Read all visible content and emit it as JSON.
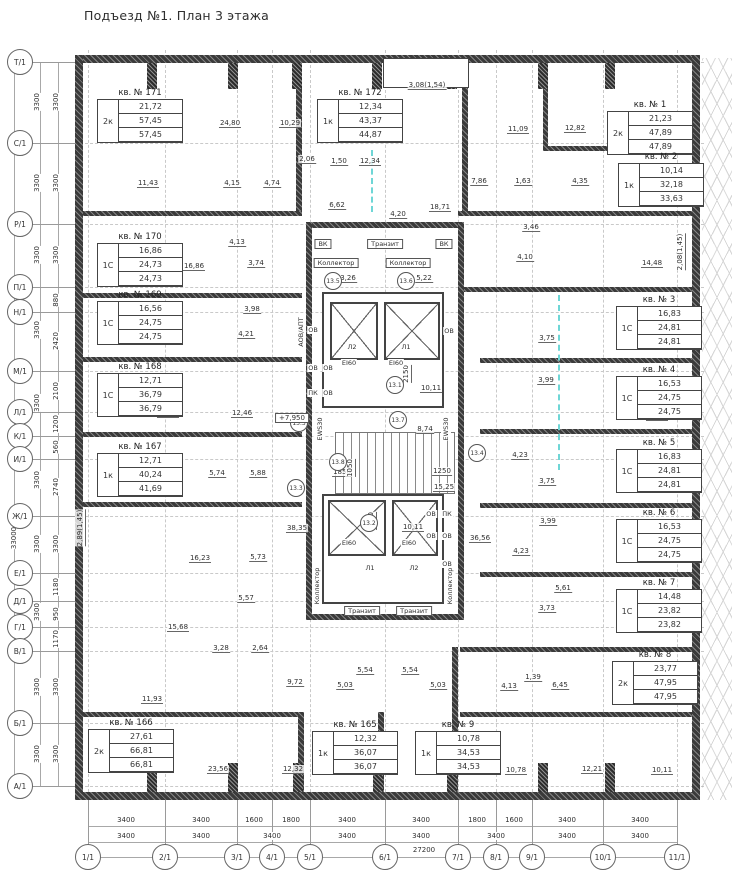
{
  "title": "Подъезд №1. План 3 этажа",
  "colors": {
    "wall": "#3a3a3a",
    "accent_cyan": "#6fd6d6",
    "grid": "#c9c9c9",
    "line": "#444444"
  },
  "axes": {
    "left": [
      {
        "label": "Т/1",
        "y": 62
      },
      {
        "label": "С/1",
        "y": 143
      },
      {
        "label": "Р/1",
        "y": 224
      },
      {
        "label": "П/1",
        "y": 287
      },
      {
        "label": "Н/1",
        "y": 312
      },
      {
        "label": "М/1",
        "y": 371
      },
      {
        "label": "Л/1",
        "y": 412
      },
      {
        "label": "К/1",
        "y": 436
      },
      {
        "label": "И/1",
        "y": 459
      },
      {
        "label": "Ж/1",
        "y": 516
      },
      {
        "label": "Е/1",
        "y": 573
      },
      {
        "label": "Д/1",
        "y": 601
      },
      {
        "label": "Г/1",
        "y": 627
      },
      {
        "label": "В/1",
        "y": 651
      },
      {
        "label": "Б/1",
        "y": 723
      },
      {
        "label": "А/1",
        "y": 786
      }
    ],
    "bottom": [
      {
        "label": "1/1",
        "x": 88
      },
      {
        "label": "2/1",
        "x": 165
      },
      {
        "label": "3/1",
        "x": 237
      },
      {
        "label": "4/1",
        "x": 272
      },
      {
        "label": "5/1",
        "x": 310
      },
      {
        "label": "6/1",
        "x": 385
      },
      {
        "label": "7/1",
        "x": 458
      },
      {
        "label": "8/1",
        "x": 496
      },
      {
        "label": "9/1",
        "x": 532
      },
      {
        "label": "10/1",
        "x": 603
      },
      {
        "label": "11/1",
        "x": 677
      }
    ]
  },
  "dimensions": {
    "bottom_row1": [
      {
        "v": "3400",
        "x": 126
      },
      {
        "v": "3400",
        "x": 201
      },
      {
        "v": "1600",
        "x": 254
      },
      {
        "v": "1800",
        "x": 291
      },
      {
        "v": "3400",
        "x": 347
      },
      {
        "v": "3400",
        "x": 421
      },
      {
        "v": "1800",
        "x": 477
      },
      {
        "v": "1600",
        "x": 514
      },
      {
        "v": "3400",
        "x": 567
      },
      {
        "v": "3400",
        "x": 640
      }
    ],
    "bottom_row2": [
      {
        "v": "3400",
        "x": 126
      },
      {
        "v": "3400",
        "x": 201
      },
      {
        "v": "3400",
        "x": 272
      },
      {
        "v": "3400",
        "x": 347
      },
      {
        "v": "3400",
        "x": 421
      },
      {
        "v": "3400",
        "x": 496
      },
      {
        "v": "3400",
        "x": 567
      },
      {
        "v": "3400",
        "x": 640
      }
    ],
    "bottom_total": {
      "v": "27200",
      "x": 424,
      "y": 850
    },
    "left_col1": [
      {
        "v": "3300",
        "y": 102
      },
      {
        "v": "3300",
        "y": 183
      },
      {
        "v": "3300",
        "y": 255
      },
      {
        "v": "3300",
        "y": 330
      },
      {
        "v": "3300",
        "y": 403
      },
      {
        "v": "3300",
        "y": 480
      },
      {
        "v": "3300",
        "y": 544
      },
      {
        "v": "3300",
        "y": 612
      },
      {
        "v": "3300",
        "y": 687
      },
      {
        "v": "3300",
        "y": 754
      }
    ],
    "left_col2": [
      {
        "v": "3300",
        "y": 102
      },
      {
        "v": "3300",
        "y": 183
      },
      {
        "v": "3300",
        "y": 255
      },
      {
        "v": "880",
        "y": 300
      },
      {
        "v": "2420",
        "y": 341
      },
      {
        "v": "2100",
        "y": 391
      },
      {
        "v": "1200",
        "y": 424
      },
      {
        "v": "560",
        "y": 447
      },
      {
        "v": "2740",
        "y": 487
      },
      {
        "v": "3300",
        "y": 544
      },
      {
        "v": "1180",
        "y": 587
      },
      {
        "v": "950",
        "y": 614
      },
      {
        "v": "1170",
        "y": 639
      },
      {
        "v": "3300",
        "y": 687
      },
      {
        "v": "3300",
        "y": 754
      }
    ],
    "left_total": {
      "v": "33000",
      "x": 14,
      "y": 538
    }
  },
  "apartments": [
    {
      "name": "кв. № 171",
      "rooms": "2к",
      "areas": [
        "21,72",
        "57,45",
        "57,45"
      ],
      "x": 97,
      "y": 88
    },
    {
      "name": "кв. № 172",
      "rooms": "1к",
      "areas": [
        "12,34",
        "43,37",
        "44,87"
      ],
      "x": 317,
      "y": 88
    },
    {
      "name": "кв. № 1",
      "rooms": "2к",
      "areas": [
        "21,23",
        "47,89",
        "47,89"
      ],
      "x": 607,
      "y": 100
    },
    {
      "name": "кв. № 2",
      "rooms": "1к",
      "areas": [
        "10,14",
        "32,18",
        "33,63"
      ],
      "x": 618,
      "y": 152
    },
    {
      "name": "кв. № 170",
      "rooms": "1С",
      "areas": [
        "16,86",
        "24,73",
        "24,73"
      ],
      "x": 97,
      "y": 232
    },
    {
      "name": "кв. № 169",
      "rooms": "1С",
      "areas": [
        "16,56",
        "24,75",
        "24,75"
      ],
      "x": 97,
      "y": 290
    },
    {
      "name": "кв. № 168",
      "rooms": "1С",
      "areas": [
        "12,71",
        "36,79",
        "36,79"
      ],
      "x": 97,
      "y": 362
    },
    {
      "name": "кв. № 167",
      "rooms": "1к",
      "areas": [
        "12,71",
        "40,24",
        "41,69"
      ],
      "x": 97,
      "y": 442
    },
    {
      "name": "кв. № 166",
      "rooms": "2к",
      "areas": [
        "27,61",
        "66,81",
        "66,81"
      ],
      "x": 88,
      "y": 718
    },
    {
      "name": "кв. № 165",
      "rooms": "1к",
      "areas": [
        "12,32",
        "36,07",
        "36,07"
      ],
      "x": 312,
      "y": 720
    },
    {
      "name": "кв. № 9",
      "rooms": "1к",
      "areas": [
        "10,78",
        "34,53",
        "34,53"
      ],
      "x": 415,
      "y": 720
    },
    {
      "name": "кв. № 3",
      "rooms": "1С",
      "areas": [
        "16,83",
        "24,81",
        "24,81"
      ],
      "x": 616,
      "y": 295
    },
    {
      "name": "кв. № 4",
      "rooms": "1С",
      "areas": [
        "16,53",
        "24,75",
        "24,75"
      ],
      "x": 616,
      "y": 365
    },
    {
      "name": "кв. № 5",
      "rooms": "1С",
      "areas": [
        "16,83",
        "24,81",
        "24,81"
      ],
      "x": 616,
      "y": 438
    },
    {
      "name": "кв. № 6",
      "rooms": "1С",
      "areas": [
        "16,53",
        "24,75",
        "24,75"
      ],
      "x": 616,
      "y": 508
    },
    {
      "name": "кв. № 7",
      "rooms": "1С",
      "areas": [
        "14,48",
        "23,82",
        "23,82"
      ],
      "x": 616,
      "y": 578
    },
    {
      "name": "кв. № 8",
      "rooms": "2к",
      "areas": [
        "23,77",
        "47,95",
        "47,95"
      ],
      "x": 612,
      "y": 650
    }
  ],
  "dim_labels": [
    {
      "v": "24,80",
      "x": 230,
      "y": 128
    },
    {
      "v": "10,29",
      "x": 290,
      "y": 128
    },
    {
      "v": "3,08(1,54)",
      "x": 427,
      "y": 90
    },
    {
      "v": "11,09",
      "x": 518,
      "y": 134
    },
    {
      "v": "12,82",
      "x": 575,
      "y": 133
    },
    {
      "v": "10,14",
      "x": 661,
      "y": 133
    },
    {
      "v": "11,43",
      "x": 148,
      "y": 188
    },
    {
      "v": "4,15",
      "x": 232,
      "y": 188
    },
    {
      "v": "4,74",
      "x": 272,
      "y": 188
    },
    {
      "v": "2,06",
      "x": 307,
      "y": 164
    },
    {
      "v": "1,50",
      "x": 339,
      "y": 166
    },
    {
      "v": "12,34",
      "x": 370,
      "y": 166
    },
    {
      "v": "7,86",
      "x": 479,
      "y": 186
    },
    {
      "v": "1,63",
      "x": 523,
      "y": 186
    },
    {
      "v": "4,35",
      "x": 580,
      "y": 186
    },
    {
      "v": "10,14",
      "x": 655,
      "y": 205
    },
    {
      "v": "6,62",
      "x": 337,
      "y": 210
    },
    {
      "v": "4,20",
      "x": 398,
      "y": 219
    },
    {
      "v": "18,71",
      "x": 440,
      "y": 212
    },
    {
      "v": "16,86",
      "x": 194,
      "y": 271
    },
    {
      "v": "4,13",
      "x": 237,
      "y": 247
    },
    {
      "v": "3,74",
      "x": 256,
      "y": 268
    },
    {
      "v": "3,46",
      "x": 531,
      "y": 232
    },
    {
      "v": "4,10",
      "x": 525,
      "y": 262
    },
    {
      "v": "14,48",
      "x": 652,
      "y": 268
    },
    {
      "v": "2,08(1,45)",
      "x": 686,
      "y": 252,
      "vert": true
    },
    {
      "v": "16,56",
      "x": 172,
      "y": 339
    },
    {
      "v": "3,98",
      "x": 252,
      "y": 314
    },
    {
      "v": "4,21",
      "x": 246,
      "y": 339
    },
    {
      "v": "3,75",
      "x": 547,
      "y": 343
    },
    {
      "v": "16,83",
      "x": 657,
      "y": 348
    },
    {
      "v": "3,99",
      "x": 546,
      "y": 385
    },
    {
      "v": "16,53",
      "x": 657,
      "y": 421
    },
    {
      "v": "12,71",
      "x": 168,
      "y": 418
    },
    {
      "v": "12,46",
      "x": 242,
      "y": 418
    },
    {
      "v": "12,71",
      "x": 168,
      "y": 478
    },
    {
      "v": "5,74",
      "x": 217,
      "y": 478
    },
    {
      "v": "5,88",
      "x": 258,
      "y": 478
    },
    {
      "v": "8,74",
      "x": 425,
      "y": 434
    },
    {
      "v": "1850",
      "x": 342,
      "y": 477
    },
    {
      "v": "1250",
      "x": 442,
      "y": 476
    },
    {
      "v": "1050",
      "x": 356,
      "y": 468,
      "vert": true
    },
    {
      "v": "15,25",
      "x": 444,
      "y": 492
    },
    {
      "v": "10,11",
      "x": 431,
      "y": 393
    },
    {
      "v": "10,11",
      "x": 413,
      "y": 532
    },
    {
      "v": "2150",
      "x": 412,
      "y": 374,
      "vert": true
    },
    {
      "v": "2150",
      "x": 377,
      "y": 521,
      "vert": true
    },
    {
      "v": "4,23",
      "x": 520,
      "y": 460
    },
    {
      "v": "3,75",
      "x": 547,
      "y": 486
    },
    {
      "v": "3,99",
      "x": 548,
      "y": 526
    },
    {
      "v": "4,23",
      "x": 521,
      "y": 556
    },
    {
      "v": "36,56",
      "x": 480,
      "y": 543
    },
    {
      "v": "16,83",
      "x": 657,
      "y": 491
    },
    {
      "v": "16,53",
      "x": 657,
      "y": 560
    },
    {
      "v": "38,35",
      "x": 297,
      "y": 533
    },
    {
      "v": "2,89(1,45)",
      "x": 86,
      "y": 528,
      "vert": true
    },
    {
      "v": "16,23",
      "x": 200,
      "y": 563
    },
    {
      "v": "5,73",
      "x": 258,
      "y": 562
    },
    {
      "v": "5,57",
      "x": 246,
      "y": 603
    },
    {
      "v": "15,68",
      "x": 178,
      "y": 632
    },
    {
      "v": "3,28",
      "x": 221,
      "y": 653
    },
    {
      "v": "2,64",
      "x": 260,
      "y": 653
    },
    {
      "v": "11,93",
      "x": 152,
      "y": 704
    },
    {
      "v": "9,72",
      "x": 295,
      "y": 687
    },
    {
      "v": "5,03",
      "x": 345,
      "y": 690
    },
    {
      "v": "5,54",
      "x": 365,
      "y": 675
    },
    {
      "v": "5,54",
      "x": 410,
      "y": 675
    },
    {
      "v": "5,03",
      "x": 438,
      "y": 690
    },
    {
      "v": "4,13",
      "x": 509,
      "y": 691
    },
    {
      "v": "1,39",
      "x": 533,
      "y": 682
    },
    {
      "v": "6,45",
      "x": 560,
      "y": 690
    },
    {
      "v": "5,61",
      "x": 563,
      "y": 593
    },
    {
      "v": "3,73",
      "x": 547,
      "y": 613
    },
    {
      "v": "14,48",
      "x": 660,
      "y": 633
    },
    {
      "v": "13,66",
      "x": 662,
      "y": 704
    },
    {
      "v": "23,56",
      "x": 218,
      "y": 774
    },
    {
      "v": "12,32",
      "x": 293,
      "y": 774
    },
    {
      "v": "13,18",
      "x": 368,
      "y": 774
    },
    {
      "v": "13,18",
      "x": 443,
      "y": 774
    },
    {
      "v": "10,78",
      "x": 516,
      "y": 775
    },
    {
      "v": "12,21",
      "x": 592,
      "y": 774
    },
    {
      "v": "10,11",
      "x": 662,
      "y": 775
    },
    {
      "v": "3,26",
      "x": 348,
      "y": 283
    },
    {
      "v": "5,22",
      "x": 424,
      "y": 283
    }
  ],
  "core": {
    "labels": [
      {
        "v": "ВК",
        "x": 323,
        "y": 244,
        "box": true
      },
      {
        "v": "Транзит",
        "x": 385,
        "y": 244,
        "box": true
      },
      {
        "v": "ВК",
        "x": 444,
        "y": 244,
        "box": true
      },
      {
        "v": "Коллектор",
        "x": 336,
        "y": 263,
        "box": true
      },
      {
        "v": "Коллектор",
        "x": 408,
        "y": 263,
        "box": true
      },
      {
        "v": "Л2",
        "x": 352,
        "y": 347
      },
      {
        "v": "Л1",
        "x": 406,
        "y": 347
      },
      {
        "v": "EI60",
        "x": 349,
        "y": 363
      },
      {
        "v": "EI60",
        "x": 396,
        "y": 363
      },
      {
        "v": "ОВ",
        "x": 313,
        "y": 330
      },
      {
        "v": "ОВ",
        "x": 449,
        "y": 331
      },
      {
        "v": "ОВ",
        "x": 313,
        "y": 368
      },
      {
        "v": "ОВ",
        "x": 328,
        "y": 368
      },
      {
        "v": "ПК",
        "x": 313,
        "y": 393
      },
      {
        "v": "ОВ",
        "x": 328,
        "y": 393
      },
      {
        "v": "АОВ/АПТ",
        "x": 301,
        "y": 332,
        "vert": true
      },
      {
        "v": "EWS30",
        "x": 320,
        "y": 429,
        "vert": true
      },
      {
        "v": "EWS30",
        "x": 446,
        "y": 429,
        "vert": true
      },
      {
        "v": "ОВ",
        "x": 431,
        "y": 514
      },
      {
        "v": "ПК",
        "x": 447,
        "y": 514
      },
      {
        "v": "ОВ",
        "x": 431,
        "y": 536
      },
      {
        "v": "ОВ",
        "x": 447,
        "y": 536
      },
      {
        "v": "ОВ",
        "x": 447,
        "y": 564
      },
      {
        "v": "Л1",
        "x": 370,
        "y": 568
      },
      {
        "v": "Л2",
        "x": 414,
        "y": 568
      },
      {
        "v": "EI60",
        "x": 349,
        "y": 543
      },
      {
        "v": "EI60",
        "x": 409,
        "y": 543
      },
      {
        "v": "Транзит",
        "x": 362,
        "y": 611,
        "box": true
      },
      {
        "v": "Транзит",
        "x": 414,
        "y": 611,
        "box": true
      },
      {
        "v": "Коллектор",
        "x": 317,
        "y": 586,
        "vert": true
      },
      {
        "v": "Коллектор",
        "x": 450,
        "y": 586,
        "vert": true
      }
    ],
    "nodes": [
      {
        "v": "13.5",
        "x": 333,
        "y": 281
      },
      {
        "v": "13.6",
        "x": 406,
        "y": 281
      },
      {
        "v": "13.1",
        "x": 395,
        "y": 385
      },
      {
        "v": "13.3",
        "x": 299,
        "y": 423
      },
      {
        "v": "13.7",
        "x": 398,
        "y": 420
      },
      {
        "v": "13.8",
        "x": 338,
        "y": 462
      },
      {
        "v": "13.3",
        "x": 296,
        "y": 488
      },
      {
        "v": "13.2",
        "x": 369,
        "y": 523
      },
      {
        "v": "13.4",
        "x": 477,
        "y": 453
      }
    ]
  },
  "elevation_mark": {
    "v": "+7,950",
    "x": 292,
    "y": 418
  }
}
